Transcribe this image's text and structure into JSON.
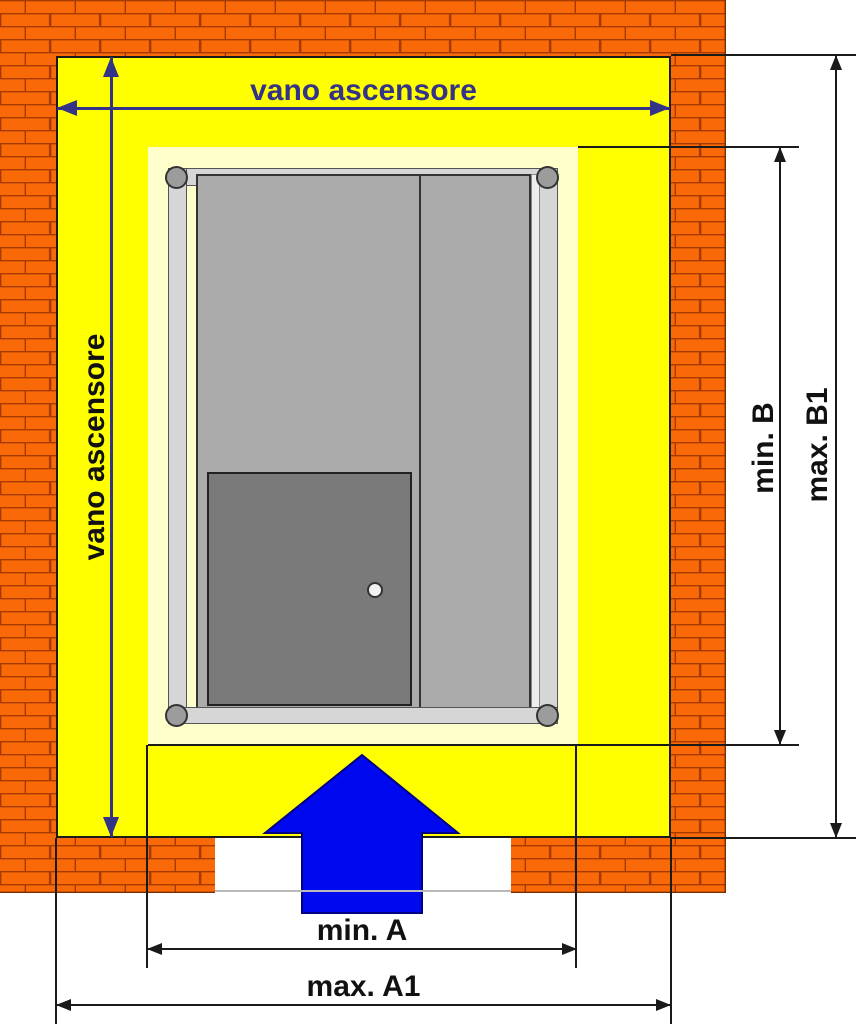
{
  "diagram": {
    "title_context": "elevator shaft plan view",
    "labels": {
      "shaft_width": "vano ascensore",
      "shaft_height": "vano ascensore",
      "min_b": "min. B",
      "max_b1": "max. B1",
      "min_a": "min. A",
      "max_a1": "max. A1"
    },
    "icons": {
      "entry_arrow": "up-arrow",
      "rollers": "corner-roller-circle",
      "door_handle": "round-knob"
    },
    "colors": {
      "brick": "#f96908",
      "mortar": "#a63a00",
      "shaft_yellow": "#ffff00",
      "clearance_cream": "#ffffcc",
      "dimension_navy": "#333388",
      "dimension_black": "#1a1a1a",
      "car_frame_gray": "#d6d6d6",
      "car_panel_gray": "#ababab",
      "car_door_gray": "#7a7a7a",
      "entry_arrow_blue": "#0008f0"
    }
  }
}
